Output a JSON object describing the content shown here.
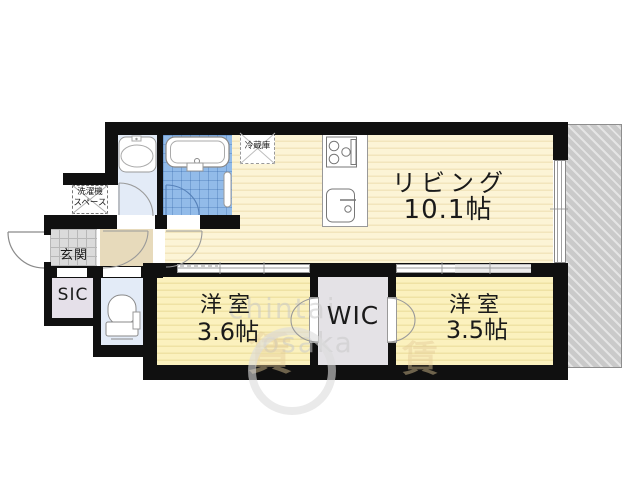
{
  "rooms": {
    "living": {
      "name": "リビング",
      "size": "10.1帖"
    },
    "bedroom_left": {
      "name": "洋室",
      "size": "3.6帖"
    },
    "bedroom_right": {
      "name": "洋室",
      "size": "3.5帖"
    },
    "wic": {
      "label": "WIC"
    },
    "sic": {
      "label": "SIC"
    },
    "entrance": {
      "label": "玄関"
    },
    "washer_space": {
      "line1": "洗濯機",
      "line2": "スペース"
    },
    "fridge": {
      "label": "冷蔵庫"
    }
  },
  "watermark": {
    "word1": "chintai",
    "word2": "osaka",
    "stamp1": "賃",
    "stamp2": "賃"
  },
  "colors": {
    "wall": "#101010",
    "living_floor": "#FCF4D6",
    "living_stripe": "#F2E5BC",
    "bedroom_floor": "#FBF1BE",
    "bedroom_stripe": "#EFE2A4",
    "wet_room": "#E3EBF7",
    "bath_tile": "#92BBE9",
    "closet": "#E5E0E9",
    "hallway": "#E7DABB",
    "entrance_tile": "#DBDBDB",
    "balcony": "#CACACA"
  }
}
